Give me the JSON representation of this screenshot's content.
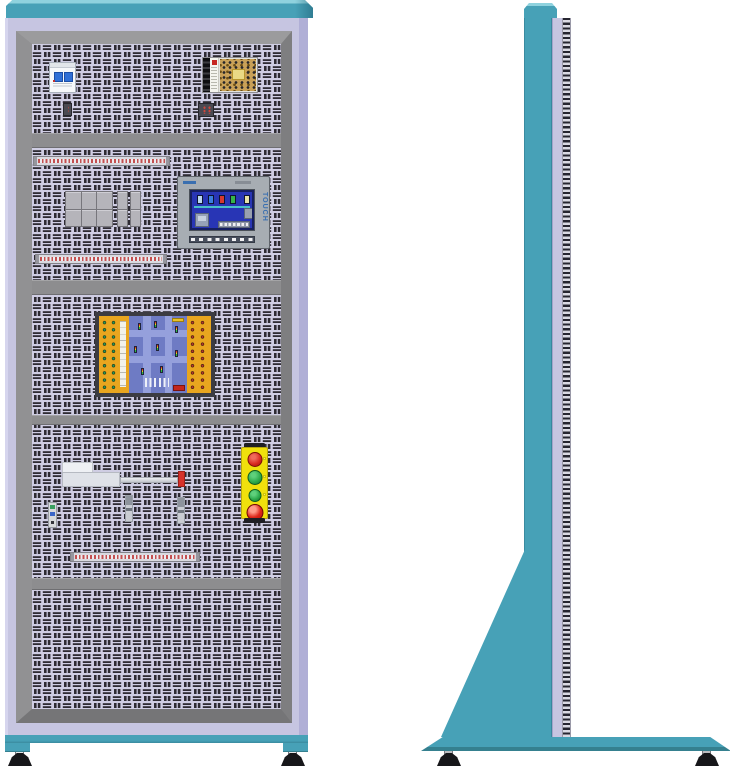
{
  "title": "Electrical automation training cabinet - front and side elevation views",
  "colors": {
    "cabinet_teal": "#47a1b7",
    "cabinet_teal_light": "#8fd2de",
    "cabinet_teal_dark": "#35808f",
    "body_lavender": "#c6c5e1",
    "frame_gray": "#8c8c8e",
    "panel_background": "#cfcde3",
    "panel_slot_dark": "#2e2b33",
    "terminal_strip_red": "#c25050",
    "button_panel_yellow": "#f0e00c",
    "button_red": "#d6281e",
    "button_green": "#2ba84a",
    "emergency_stop_red": "#dd2619",
    "hmi_screen_blue": "#2835b5",
    "board_field_blue": "#6e7bc4",
    "board_terminal_orange": "#e9a61f",
    "actuator_tip_red": "#d6322a",
    "breaker_toggle_blue": "#2f6fd6",
    "foot_black": "#17171a"
  },
  "front_view": {
    "sections": [
      {
        "name": "incoming-power-section",
        "components": [
          "circuit-breaker",
          "switching-power-supply",
          "terminal-connector-small",
          "terminal-connector-small"
        ]
      },
      {
        "name": "control-section",
        "components": [
          "terminal-strip-row",
          "relay-module-group",
          "hmi-touch-panel",
          "terminal-strip-row"
        ]
      },
      {
        "name": "simulation-section",
        "components": [
          "traffic-intersection-trainer-board"
        ]
      },
      {
        "name": "actuation-section",
        "components": [
          "linear-actuator-with-rod",
          "inductive-sensor",
          "inductive-sensor",
          "sensor-board",
          "push-button-station",
          "terminal-strip-row"
        ]
      },
      {
        "name": "blank-vented-section",
        "components": []
      }
    ],
    "hmi": {
      "side_label": "TOUCH"
    },
    "push_button_station": {
      "buttons": [
        "red-push-button",
        "green-push-button",
        "green-push-button",
        "emergency-stop-mushroom-button"
      ]
    }
  },
  "side_view": {
    "parts": [
      "top-cap",
      "upright-column",
      "perforated-panel-edge",
      "triangular-gusset",
      "floor-base-plate",
      "leveling-foot",
      "leveling-foot"
    ]
  }
}
